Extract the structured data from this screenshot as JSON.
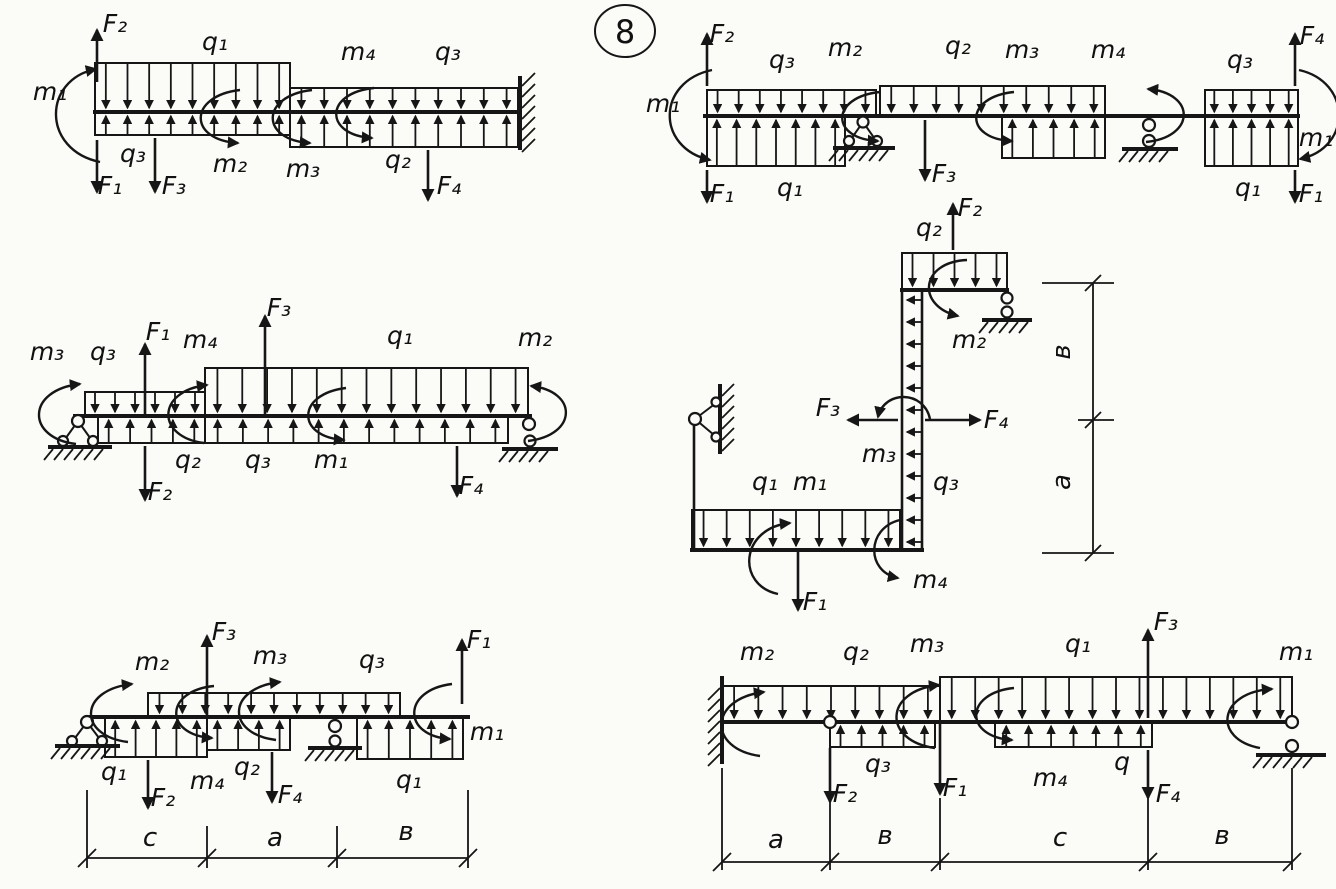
{
  "figure_number": "8",
  "colors": {
    "ink": "#161616",
    "paper": "#fbfbf8"
  },
  "diagrams": {
    "d1": {
      "name": "top-left cantilever fixed at right",
      "labels": {
        "m1": "m₁",
        "F2": "F₂",
        "F1": "F₁",
        "q1": "q₁",
        "q3_left": "q₃",
        "F3": "F₃",
        "m2": "m₂",
        "m3": "m₃",
        "m4": "m₄",
        "q3_right": "q₃",
        "q2": "q₂",
        "F4": "F₄"
      }
    },
    "d2": {
      "name": "top-right beam on pin and roller",
      "labels": {
        "F2": "F₂",
        "m1_left": "m₁",
        "F1_left": "F₁",
        "q3_left": "q₃",
        "q1_left": "q₁",
        "m2": "m₂",
        "q2": "q₂",
        "F3": "F₃",
        "m3": "m₃",
        "m4": "m₄",
        "q3_right": "q₃",
        "q1_right": "q₁",
        "F4": "F₄",
        "m1_right": "m₁",
        "F1_right": "F₁"
      }
    },
    "d3": {
      "name": "middle-left beam on pin and roller",
      "labels": {
        "m3": "m₃",
        "q3_top": "q₃",
        "F1": "F₁",
        "m4": "m₄",
        "F3": "F₃",
        "q1": "q₁",
        "m2": "m₂",
        "q2": "q₂",
        "F2": "F₂",
        "q3_bottom": "q₃",
        "m1": "m₁",
        "F4": "F₄"
      }
    },
    "d4": {
      "name": "middle-right stepped frame",
      "labels": {
        "q2": "q₂",
        "F2": "F₂",
        "m2": "m₂",
        "m3": "m₃",
        "F3": "F₃",
        "F4": "F₄",
        "q3": "q₃",
        "q1": "q₁",
        "m1": "m₁",
        "m4": "m₄",
        "F1": "F₁",
        "dim_b": "в",
        "dim_a": "a"
      }
    },
    "d5": {
      "name": "bottom-left beam on pin and roller",
      "labels": {
        "m2": "m₂",
        "F3": "F₃",
        "m3": "m₃",
        "q3": "q₃",
        "F1": "F₁",
        "q1_left": "q₁",
        "F2": "F₂",
        "m4": "m₄",
        "q2": "q₂",
        "F4": "F₄",
        "q1_right": "q₁",
        "m1": "m₁",
        "dim_c": "c",
        "dim_a": "a",
        "dim_b": "в"
      }
    },
    "d6": {
      "name": "bottom-right beam fixed at left with roller at right",
      "labels": {
        "m2": "m₂",
        "q2": "q₂",
        "m3": "m₃",
        "q1": "q₁",
        "F3": "F₃",
        "m1": "m₁",
        "F2": "F₂",
        "q3": "q₃",
        "F1": "F₁",
        "m4": "m₄",
        "q": "q",
        "F4": "F₄",
        "dim_a": "a",
        "dim_b": "в",
        "dim_c": "c",
        "dim_b2": "в"
      }
    }
  }
}
